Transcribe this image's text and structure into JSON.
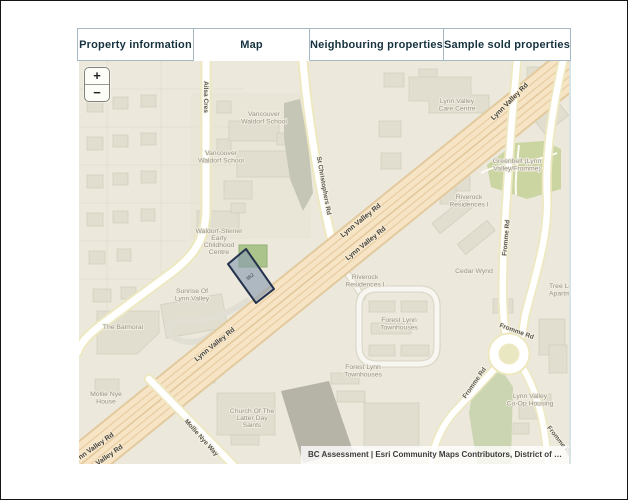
{
  "tabs": [
    {
      "label": "Property information",
      "active": false
    },
    {
      "label": "Map",
      "active": true
    },
    {
      "label": "Neighbouring properties",
      "active": false
    },
    {
      "label": "Sample sold properties",
      "active": false
    }
  ],
  "map": {
    "zoom_in": "+",
    "zoom_out": "−",
    "attribution": "BC Assessment | Esri Community Maps Contributors, District of …",
    "parcel": {
      "number": "362"
    },
    "labels": {
      "ailsa_cres": {
        "lines": [
          "Ailsa Cres"
        ]
      },
      "waldorf_school_1": {
        "lines": [
          "Vancouver",
          "Waldorf School"
        ]
      },
      "waldorf_school_2": {
        "lines": [
          "Vancouver",
          "Waldorf School"
        ]
      },
      "st_christophers_rd": {
        "lines": [
          "St Christophers Rd"
        ]
      },
      "care_centre": {
        "lines": [
          "Lynn Valley",
          "Care Centre"
        ]
      },
      "lynn_valley_rd_ne": {
        "lines": [
          "Lynn Valley Rd"
        ]
      },
      "greenbelt": {
        "lines": [
          "Greenbelt (Lynn",
          "Valley/Fromme)"
        ]
      },
      "riverock_1": {
        "lines": [
          "Riverock",
          "Residences I"
        ]
      },
      "lynn_valley_rd_c1": {
        "lines": [
          "Lynn Valley Rd"
        ]
      },
      "lynn_valley_rd_c2": {
        "lines": [
          "Lynn Valley Rd"
        ]
      },
      "waldorf_steiner": {
        "lines": [
          "Waldorf-Steiner",
          "Early",
          "Childhood",
          "Centre"
        ]
      },
      "riverock_2": {
        "lines": [
          "Riverock",
          "Residences I"
        ]
      },
      "cedar_wynd": {
        "lines": [
          "Cedar Wynd"
        ]
      },
      "fromme_rd_n": {
        "lines": [
          "Fromme Rd"
        ]
      },
      "tree_lodge": {
        "lines": [
          "Tree Lo",
          "Apartme"
        ]
      },
      "sunrise": {
        "lines": [
          "Sunrise Of",
          "Lynn Valley"
        ]
      },
      "forest_lynn_1": {
        "lines": [
          "Forest Lynn",
          "Townhouses"
        ]
      },
      "the_balmoral": {
        "lines": [
          "The Balmoral"
        ]
      },
      "lynn_valley_rd_c3": {
        "lines": [
          "Lynn Valley Rd"
        ]
      },
      "fromme_rd_rb_top": {
        "lines": [
          "Fromme Rd"
        ]
      },
      "forest_lynn_2": {
        "lines": [
          "Forest Lynn",
          "Townhouses"
        ]
      },
      "fromme_rd_rb_left": {
        "lines": [
          "Fromme Rd"
        ]
      },
      "mollie_nye_house": {
        "lines": [
          "Mollie Nye",
          "House"
        ]
      },
      "church": {
        "lines": [
          "Church Of The",
          "Latter Day",
          "Saints"
        ]
      },
      "mollie_nye_way": {
        "lines": [
          "Mollie Nye Way"
        ]
      },
      "coop_housing": {
        "lines": [
          "Lynn Valley",
          "Co-Op Housing"
        ]
      },
      "fromme_rd_se": {
        "lines": [
          "Fromme Rd"
        ]
      },
      "lynn_valley_rd_sw1": {
        "lines": [
          "Lynn Valley Rd"
        ]
      },
      "lynn_valley_rd_sw2": {
        "lines": [
          "Lynn Valley Rd"
        ]
      }
    }
  }
}
